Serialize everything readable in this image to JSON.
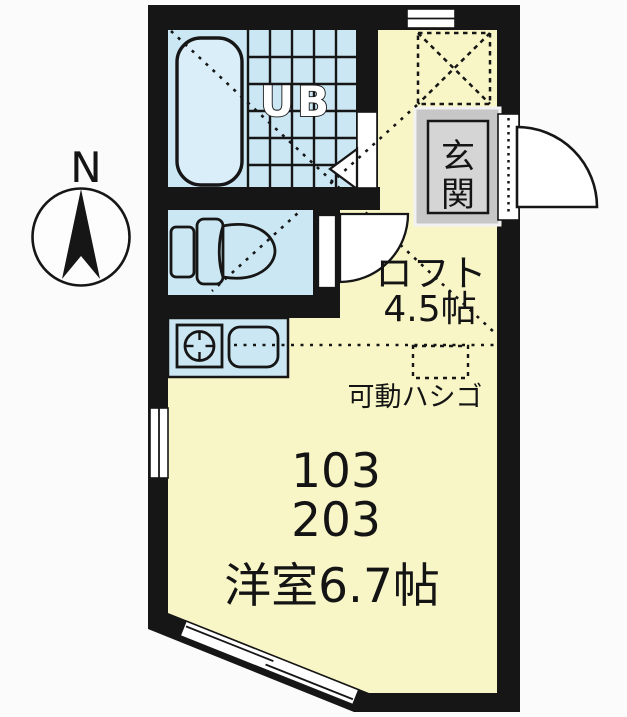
{
  "compass": {
    "north": "N"
  },
  "labels": {
    "unit_bath": "UB",
    "entrance": {
      "char1": "玄",
      "char2": "関"
    },
    "loft_name": "ロフト",
    "loft_size": "4.5帖",
    "ladder": "可動ハシゴ",
    "room_number_1": "103",
    "room_number_2": "203",
    "main_room": "洋室6.7帖"
  },
  "colors": {
    "background": "#fbfbfb",
    "wall": "#161616",
    "room_yellow": "#f8f6c6",
    "wet_area_cyan": "#cbe7f3",
    "bathtub_fill": "#d9eef8",
    "entrance_gray": "#c7c7c7",
    "entrance_inner_gray": "#d5d5d5",
    "text": "#141414"
  }
}
